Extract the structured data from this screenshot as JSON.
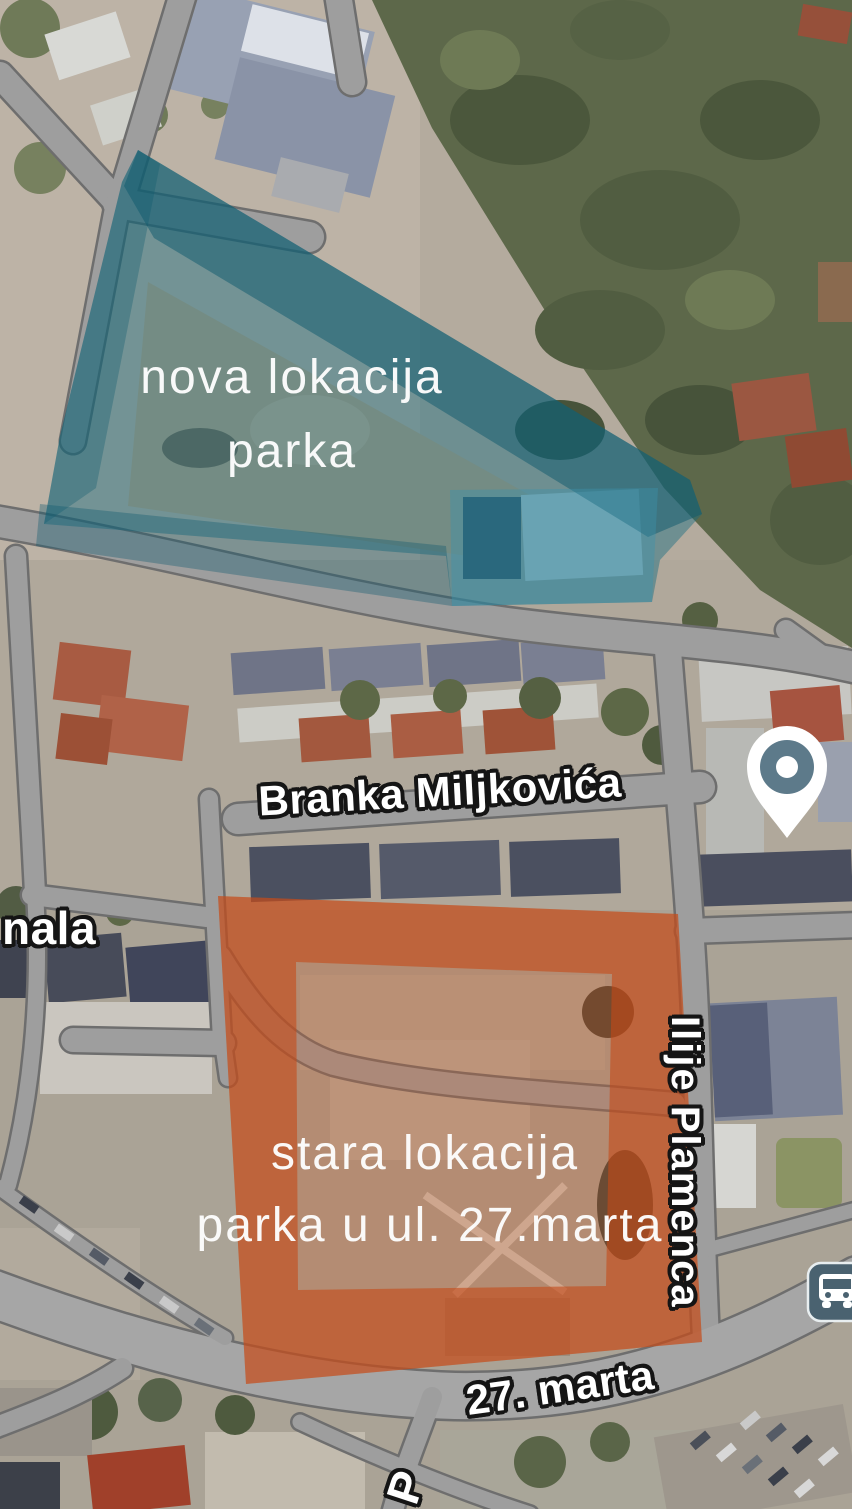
{
  "map": {
    "view": "satellite",
    "annotations": {
      "new_park_area": {
        "label_line1": "nova lokacija",
        "label_line2": "parka",
        "fill_color": "#1d6c80"
      },
      "old_park_area": {
        "label_line1": "stara lokacija",
        "label_line2": "parka u ul. 27.marta",
        "fill_color": "#c2531f"
      }
    },
    "street_labels": {
      "branka_miljkovica": "Branka Miljkovića",
      "ilije_plamenca": "Ilije Plamenca",
      "marta_27": "27. marta",
      "left_edge_partial": "nala",
      "bottom_edge_partial": "P"
    },
    "markers": {
      "location_pin": {
        "color": "#5d7a8a"
      },
      "bus_stop": {
        "color": "#4a6270"
      }
    },
    "palette": {
      "road": "#9e9e9e",
      "road_outline": "#6e6e6e",
      "forest": "#5d684a",
      "ground": "#b4ab9e"
    }
  }
}
